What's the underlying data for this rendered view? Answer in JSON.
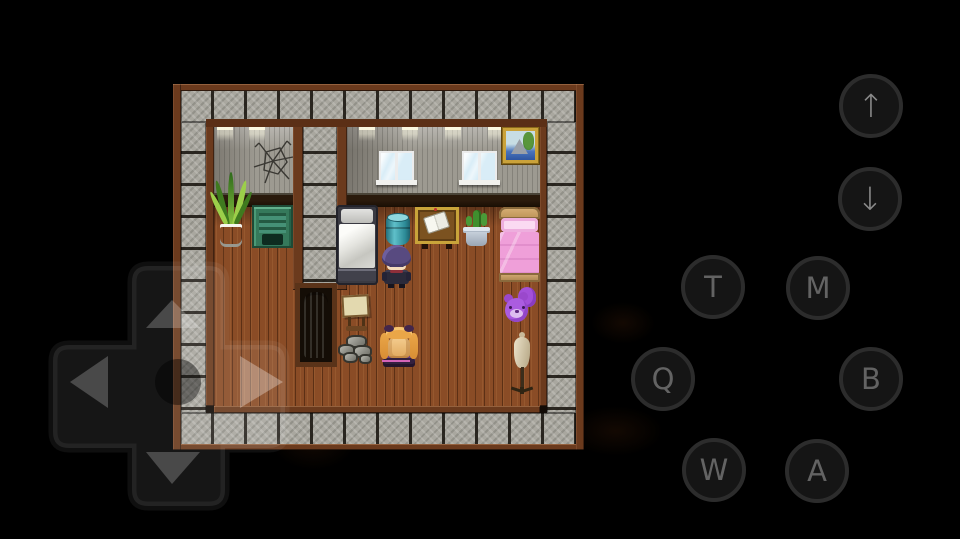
{
  "app": {
    "background": "#000000",
    "type": "mobile-rpg-emulator"
  },
  "controls": {
    "dpad": {
      "name": "directional-pad",
      "arrows": [
        "up",
        "down",
        "left",
        "right"
      ]
    },
    "action_buttons": [
      {
        "id": "up",
        "label": "↑"
      },
      {
        "id": "down",
        "label": "↓"
      },
      {
        "id": "t",
        "label": "T"
      },
      {
        "id": "m",
        "label": "M"
      },
      {
        "id": "q",
        "label": "Q"
      },
      {
        "id": "b",
        "label": "B"
      },
      {
        "id": "w",
        "label": "W"
      },
      {
        "id": "a",
        "label": "A"
      }
    ]
  },
  "scene": {
    "type": "rpg-bedroom",
    "objects": [
      "stone-tile-border",
      "wood-trim",
      "grey-plank-wall",
      "cracked-wall",
      "wooden-floor",
      "snake-plant",
      "green-locker",
      "grey-bed",
      "teal-barrel",
      "book-table",
      "potted-cactus",
      "pink-bed",
      "purple-teddy-bear",
      "dress-mannequin",
      "white-bedroll-recess",
      "easel-desk",
      "rock-pile",
      "window",
      "window",
      "landscape-painting",
      "ceiling-lights"
    ],
    "characters": [
      {
        "id": "player",
        "description": "purple-haired character standing, facing camera"
      },
      {
        "id": "npc",
        "description": "blonde twin-tail character sitting on purple stool, facing away"
      }
    ],
    "palette": {
      "floor": "#8a4c26",
      "wall": "#9d9a91",
      "stone": "#a9a79f",
      "trim": "#6b3a1d",
      "bed_pink": "#ef9fd9",
      "barrel_teal": "#3aa0ac",
      "teddy_purple": "#a350d8"
    }
  }
}
